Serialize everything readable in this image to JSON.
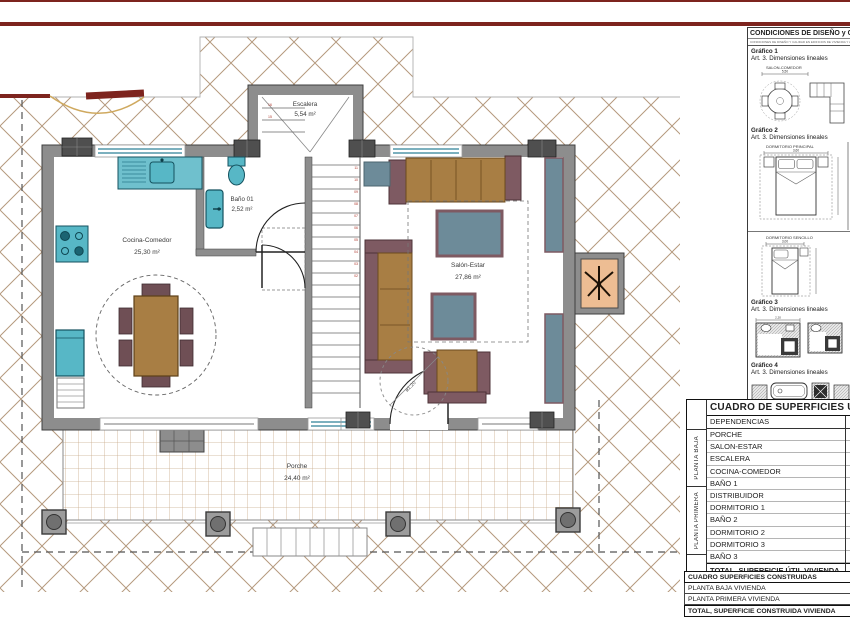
{
  "plan": {
    "rooms": {
      "escalera": {
        "label": "Escalera",
        "area": "5,54 m²"
      },
      "bano01": {
        "label": "Baño 01",
        "area": "2,52 m²"
      },
      "cocina": {
        "label": "Cocina-Comedor",
        "area": "25,30 m²"
      },
      "salon": {
        "label": "Salón-Estar",
        "area": "27,86 m²"
      },
      "porche": {
        "label": "Porche",
        "area": "24,40 m²"
      }
    },
    "annotations": {
      "turning_circle": "ø1,20"
    },
    "stair_numbers": [
      "11",
      "10",
      "09",
      "08",
      "07",
      "06",
      "05",
      "04",
      "03",
      "02"
    ],
    "stair_numbers_left": [
      "16",
      "15"
    ]
  },
  "panel": {
    "title": "CONDICIONES DE DISEÑO y CA",
    "subtitle": "CONDICIONES DE DISEÑO Y CALIDAD EN EDIFICIOS DE VIVIENDA Y ALOJAMIENTO",
    "graficos": [
      {
        "label": "Gráfico 1",
        "caption": "Art. 3. Dimensiones lineales",
        "name": "SALON-COMEDOR",
        "dim": "5,50"
      },
      {
        "label": "Gráfico 2",
        "caption": "Art. 3. Dimensiones lineales",
        "name": "DORMITORIO PRINCIPAL",
        "dim": "3,60",
        "name2": "DORMITORIO SENCILLO",
        "dim2": "3,00"
      },
      {
        "label": "Gráfico 3",
        "caption": "Art. 3. Dimensiones lineales",
        "dim": "2,20"
      },
      {
        "label": "Gráfico 4",
        "caption": "Art. 3. Dimensiones lineales",
        "dim_a": "0,70",
        "dim_b": "0,70",
        "dim_c": "1,20"
      }
    ]
  },
  "tables": {
    "useful": {
      "title": "CUADRO DE SUPERFICIES UTI",
      "header": "DEPENDENCIAS",
      "groups": [
        {
          "label": "PLANTA BAJA",
          "rows": [
            "PORCHE",
            "SALON-ESTAR",
            "ESCALERA",
            "COCINA-COMEDOR",
            "BAÑO 1"
          ]
        },
        {
          "label": "PLANTA PRIMERA",
          "rows": [
            "DISTRIBUIDOR",
            "DORMITORIO 1",
            "BAÑO 2",
            "DORMITORIO 2",
            "DORMITORIO 3",
            "BAÑO 3"
          ]
        }
      ],
      "total": "TOTAL, SUPERFICIE ÚTIL VIVIENDA"
    },
    "built": {
      "title": "CUADRO SUPERFICIES CONSTRUIDAS",
      "rows": [
        "PLANTA BAJA VIVIENDA",
        "PLANTA PRIMERA VIVIENDA"
      ],
      "total": "TOTAL, SUPERFICIE CONSTRUIDA VIVIENDA",
      "pool": "SUPERFICIE LAMINA DE AGUA - PISCINA"
    }
  },
  "colors": {
    "accent_red": "#7d241e",
    "hatch": "#b59a7e",
    "wall": "#8d8d8d",
    "teal": "#57b7c6",
    "wood": "#a87e44",
    "mauve": "#7e5a62",
    "bluegray": "#6d8b99",
    "salmon": "#edbd93",
    "tile": "#c9ab8c"
  }
}
